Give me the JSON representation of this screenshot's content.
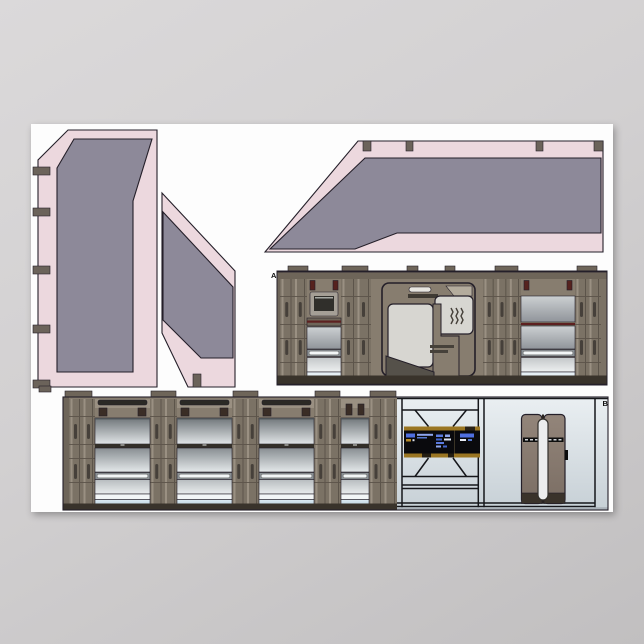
{
  "poster": {
    "description": "papercraft sci-fi corridor cut-out sheet",
    "labels": {
      "piece_a": "A",
      "piece_b": "B"
    }
  },
  "colors": {
    "background_top": "#dbd9da",
    "background_bottom": "#c1bfc0",
    "poster_white": "#fdfdfd",
    "outline": "#241f29",
    "pink": "#ecd8de",
    "slate": "#8d8999",
    "tab": "#6b635a",
    "brown_base": "#877d6f",
    "brown_mid": "#7b7265",
    "brown_dark": "#6e6559",
    "brown_light": "#9a9082",
    "slot_dark": "#46403a",
    "baseboard": "#39332b",
    "red_accent": "#5d2020",
    "red_slot": "#56221e",
    "light_area": "#d7d6d1",
    "canopy_light": "#b4ac9d",
    "bench": "#55514a",
    "monitor_bezel": "#a59f96",
    "monitor_screen": "#302f2b",
    "rail_bg": "#8a9094",
    "rail_white": "#f3f6f7",
    "pale_blue": "#e6eff5",
    "line_art": "#15161a",
    "lcars_amber": "#9a7522",
    "lcars_amber_bright": "#b68a28",
    "lcars_blue": "#4f6fe0",
    "lcars_blue_light": "#8ea6ee",
    "screen_black": "#0a0a0d",
    "door_kick": "#3a332b",
    "capsule": "#ecedee",
    "wall_band": "#aab2b9",
    "ink": "#111111"
  }
}
